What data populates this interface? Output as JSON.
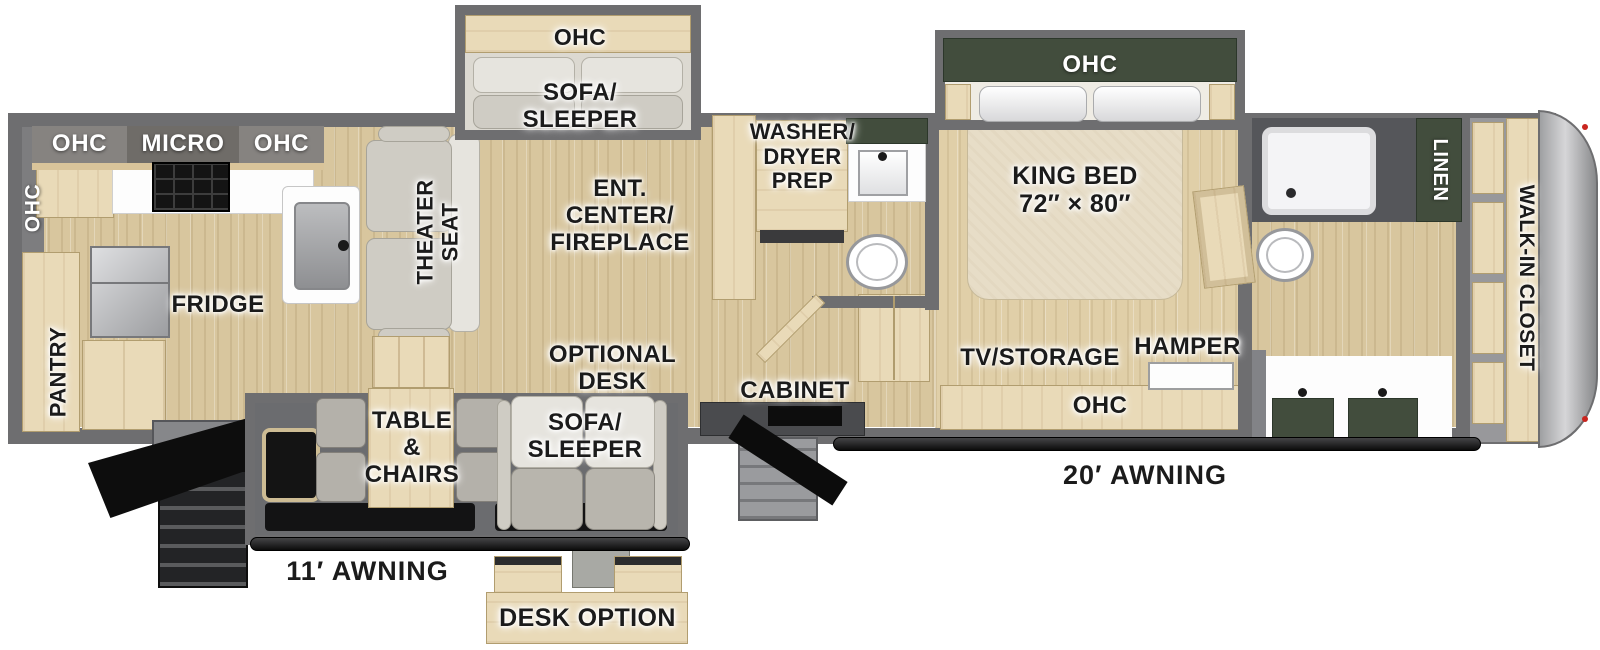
{
  "title": "Fifth Wheel RV Floorplan",
  "colors": {
    "wall": "#6e6e70",
    "floor_wood": "#d8c69e",
    "cabinet_wood": "#e9dab8",
    "accent_green": "#424d3d",
    "nose_silver": "#c9c9cb",
    "steps_black": "#121212",
    "marker_light_red": "#c9251f"
  },
  "labels": {
    "kitchen_ohc_left": "OHC",
    "kitchen_band_ohc1": "OHC",
    "kitchen_band_micro": "MICRO",
    "kitchen_band_ohc2": "OHC",
    "pantry": "PANTRY",
    "fridge": "FRIDGE",
    "theater_seat": "THEATER\nSEAT",
    "sofa_slide_ohc": "OHC",
    "sofa_sleeper_top": "SOFA/\nSLEEPER",
    "ent_center": "ENT.\nCENTER/\nFIREPLACE",
    "washer_dryer_prep": "WASHER/\nDRYER\nPREP",
    "king_slide_ohc": "OHC",
    "king_bed": "KING BED\n72″ × 80″",
    "linen": "LINEN",
    "walk_in_closet": "WALK-IN CLOSET",
    "tv_storage": "TV/STORAGE",
    "hamper": "HAMPER",
    "bedroom_ohc": "OHC",
    "cabinet": "CABINET",
    "optional_desk": "OPTIONAL\nDESK",
    "sofa_sleeper_bottom": "SOFA/\nSLEEPER",
    "table_chairs": "TABLE\n&\nCHAIRS",
    "awning_20": "20′ AWNING",
    "awning_11": "11′ AWNING",
    "desk_option": "DESK OPTION"
  }
}
